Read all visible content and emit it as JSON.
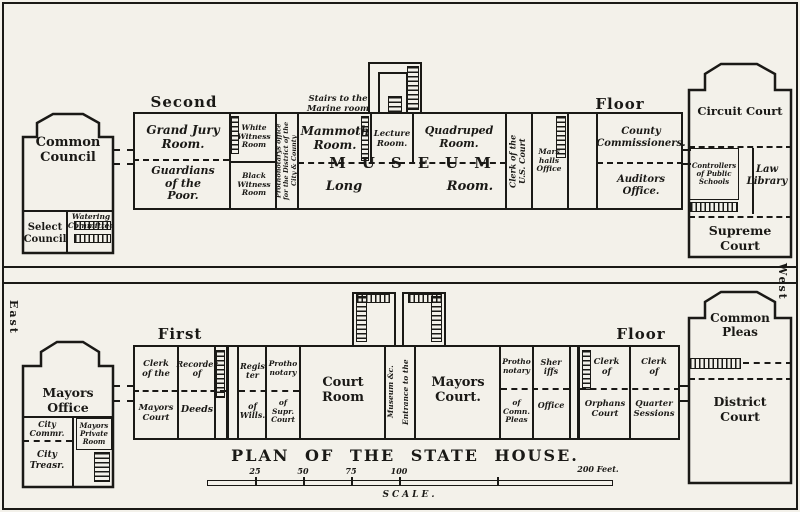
{
  "plan": {
    "title": "PLAN OF THE STATE HOUSE.",
    "orientation": {
      "east": "East",
      "west": "West"
    },
    "scale": {
      "label": "SCALE.",
      "t25": "25",
      "t50": "50",
      "t75": "75",
      "t100": "100",
      "t200": "200 Feet."
    },
    "second_floor": {
      "heading_left": "Second",
      "heading_right": "Floor",
      "common_council_building": {
        "common_council": "Common\nCouncil",
        "select_council": "Select\nCouncil",
        "watering_committee": "Watering\nCommittee"
      },
      "main_range": {
        "grand_jury": "Grand Jury\nRoom.",
        "guardians": "Guardians\nof the\nPoor.",
        "white_witness": "White\nWitness\nRoom",
        "black_witness": "Black\nWitness\nRoom",
        "prothonotarys_office": "Prothonotarys office\nfor the District of the\nCity & County",
        "stairs_to_marine": "Stairs to the\nMarine room",
        "mammoth": "Mammoth\nRoom.",
        "lecture": "Lecture\nRoom.",
        "quadruped": "Quadruped\nRoom.",
        "museum": "MUSEUM",
        "long": "Long",
        "long_room": "Room.",
        "clerk_us_court": "Clerk of the\nU.S. Court",
        "marshalls_office": "Mars\nhalls\nOffice",
        "county_commissioners": "County\nCommissioners.",
        "auditors_office": "Auditors Office."
      },
      "circuit_court_building": {
        "circuit_court": "Circuit Court",
        "controllers": "Controllers\nof Public\nSchools",
        "law_library": "Law\nLibrary",
        "supreme_court": "Supreme\nCourt"
      }
    },
    "first_floor": {
      "heading_left": "First",
      "heading_right": "Floor",
      "mayors_office_building": {
        "mayors_office": "Mayors Office",
        "city_commissioner": "City\nCommr.",
        "city_treasurer": "City\nTreasr.",
        "mayors_private": "Mayors\nPrivate\nRoom"
      },
      "main_range": {
        "clerk_of_the": "Clerk\nof the",
        "mayors_court_lower": "Mayors\nCourt",
        "recorder_of": "Recorder\nof",
        "deeds": "Deeds",
        "register": "Regis\nter",
        "of_wills": "of\nWills.",
        "prothonotary_supr_top": "Protho\nnotary",
        "of_supr_court": "of\nSupr.\nCourt",
        "court_room": "Court\nRoom",
        "entrance_to_the": "Entrance to the",
        "museum_etc": "Museum &c.",
        "mayors_court": "Mayors\nCourt.",
        "prothonotary_comn_top": "Protho\nnotary",
        "of_comn_pleas": "of\nComn.\nPleas",
        "sheriffs": "Sher\niffs",
        "sheriffs_office": "Office",
        "clerk_orphans_top": "Clerk\nof",
        "orphans_court": "Orphans\nCourt",
        "clerk_quarter_top": "Clerk\nof",
        "quarter_sessions": "Quarter\nSessions"
      },
      "common_pleas_building": {
        "common_pleas": "Common\nPleas",
        "district_court": "District\nCourt"
      }
    }
  }
}
